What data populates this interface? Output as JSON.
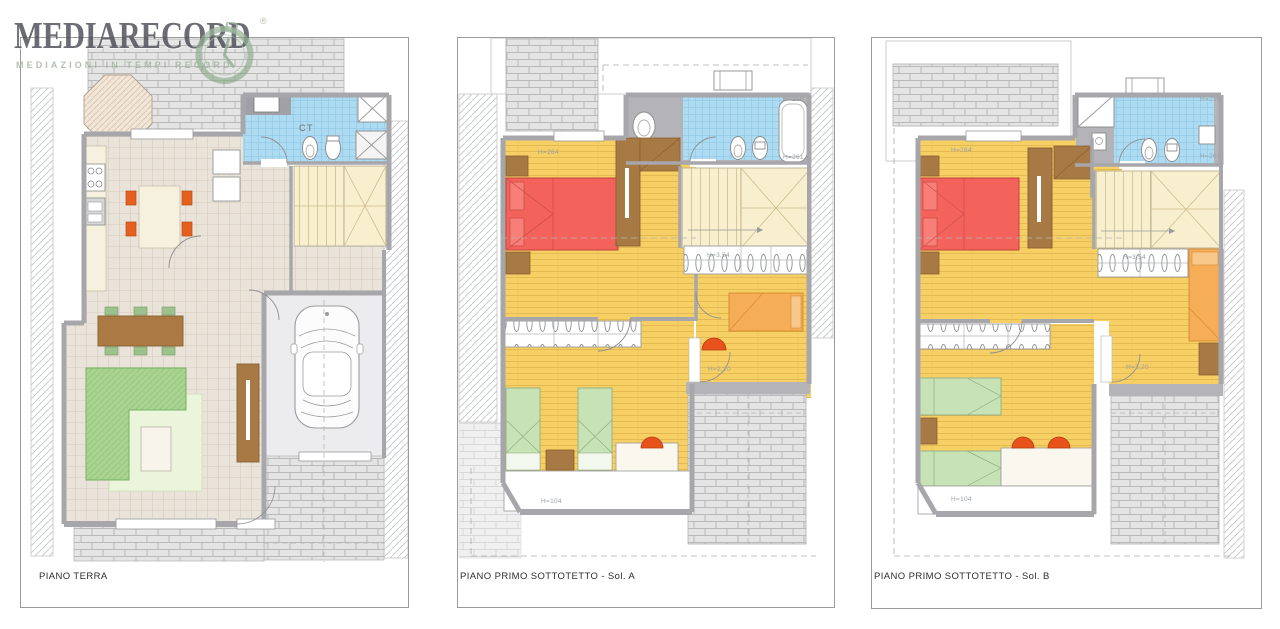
{
  "logo": {
    "title": "MEDIARECORD",
    "tagline": "MEDIAZIONI IN TEMPI RECORD",
    "registered_mark": "®",
    "icon": "clock-icon",
    "colors": {
      "title": "#4d4d57",
      "tagline": "#a3b3a1",
      "clock": "#86a884"
    }
  },
  "panels": [
    {
      "label": "PIANO TERRA",
      "annotations": {
        "boiler_room": "CT"
      }
    },
    {
      "label": "PIANO PRIMO SOTTOTETTO - Sol. A",
      "annotations": {
        "bedroom_height": "H=264",
        "bath_height_high": "H=216",
        "bath_height_low": "H=261",
        "wardrobe_label": "H=3,54",
        "room_height": "H=2,20",
        "low_attic_height": "H=104"
      }
    },
    {
      "label": "PIANO PRIMO SOTTOTETTO - Sol. B",
      "annotations": {
        "bedroom_height": "H=264",
        "bath_height_high": "H=216",
        "bath_height_low": "H=261",
        "wardrobe_label": "H=3,54",
        "room_height": "H=2,20",
        "low_attic_height": "H=104"
      }
    }
  ],
  "colors": {
    "wall_gray": "#a7a7ab",
    "bath_tile_blue": "#addbf2",
    "floor_tile_beige": "#eae3d9",
    "floor_plank_yellow": "#f6cf65",
    "stair_cream": "#f8efce",
    "bed_red": "#f4625c",
    "bed_green": "#c7e2b4",
    "bed_orange": "#f5ad57",
    "accent_orange": "#e8531b",
    "sofa_green": "#a9d491",
    "furniture_brown": "#a77a45",
    "brick_gray": "#e4e4e4"
  }
}
